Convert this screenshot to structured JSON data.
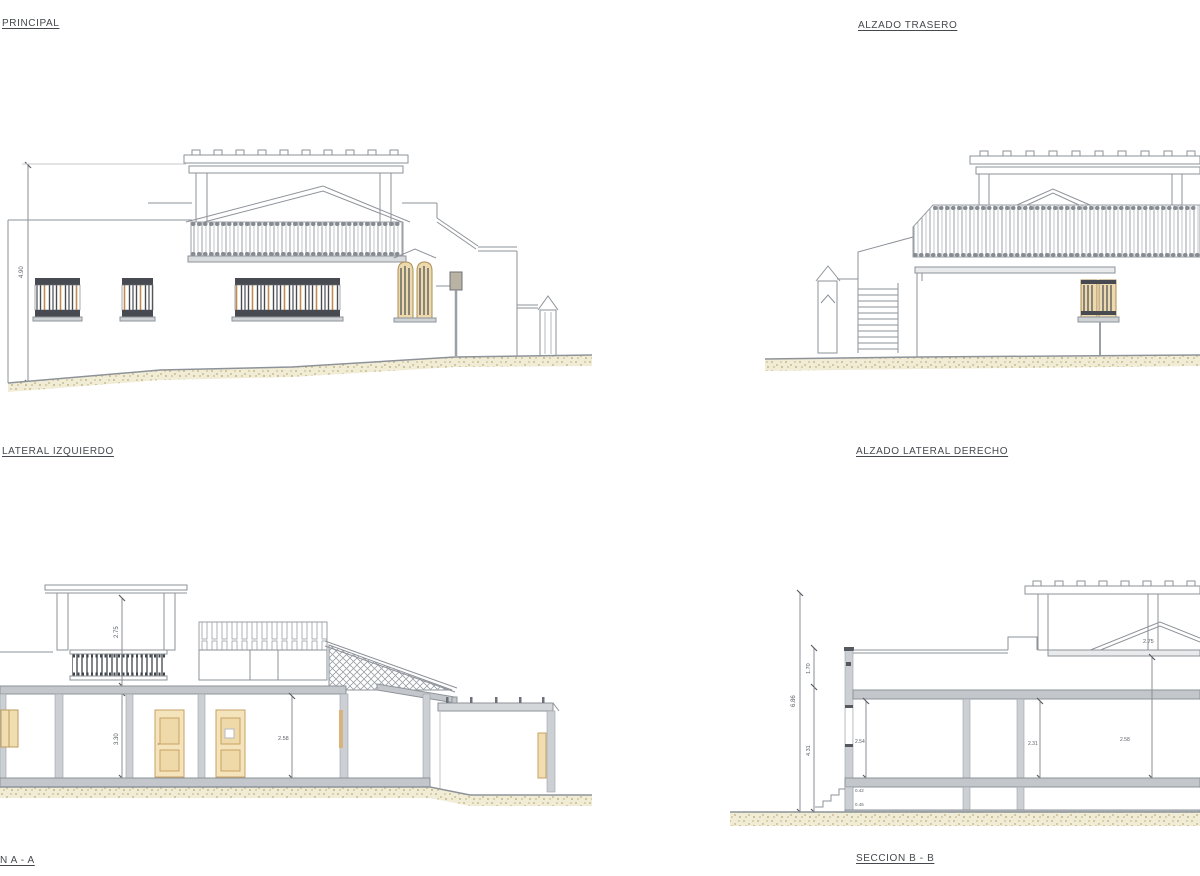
{
  "sheet": {
    "title": "architectural elevations and sections sheet",
    "background": "#ffffff"
  },
  "labels": {
    "top_left": "PRINCIPAL",
    "top_right": "ALZADO TRASERO",
    "mid_left": "LATERAL IZQUIERDO",
    "mid_right": "ALZADO LATERAL DERECHO",
    "bottom_left": "N A - A",
    "bottom_right": "SECCION B - B"
  },
  "dims": {
    "principal_height": "4.90",
    "a_tower": "2.75",
    "a_slab": "0.40",
    "a_room": "3.30",
    "a_room2": "2.58",
    "b_total": "6.86",
    "b_upper": "1.70",
    "b_lower": "4.31",
    "b_gable": "2.75",
    "b_room1": "2.54",
    "b_room2": "2.31",
    "b_room3": "2.58",
    "b_slab": "0.42",
    "b_foot": "0.45"
  },
  "colors": {
    "line": "#8e939a",
    "wall_cut": "#ccd0d4",
    "slab": "#c3c7cb",
    "door_tan": "#f5e3bb",
    "frame_tan": "#c7a264",
    "grille_dark": "#474b51",
    "sand": "#e9e0ba"
  }
}
